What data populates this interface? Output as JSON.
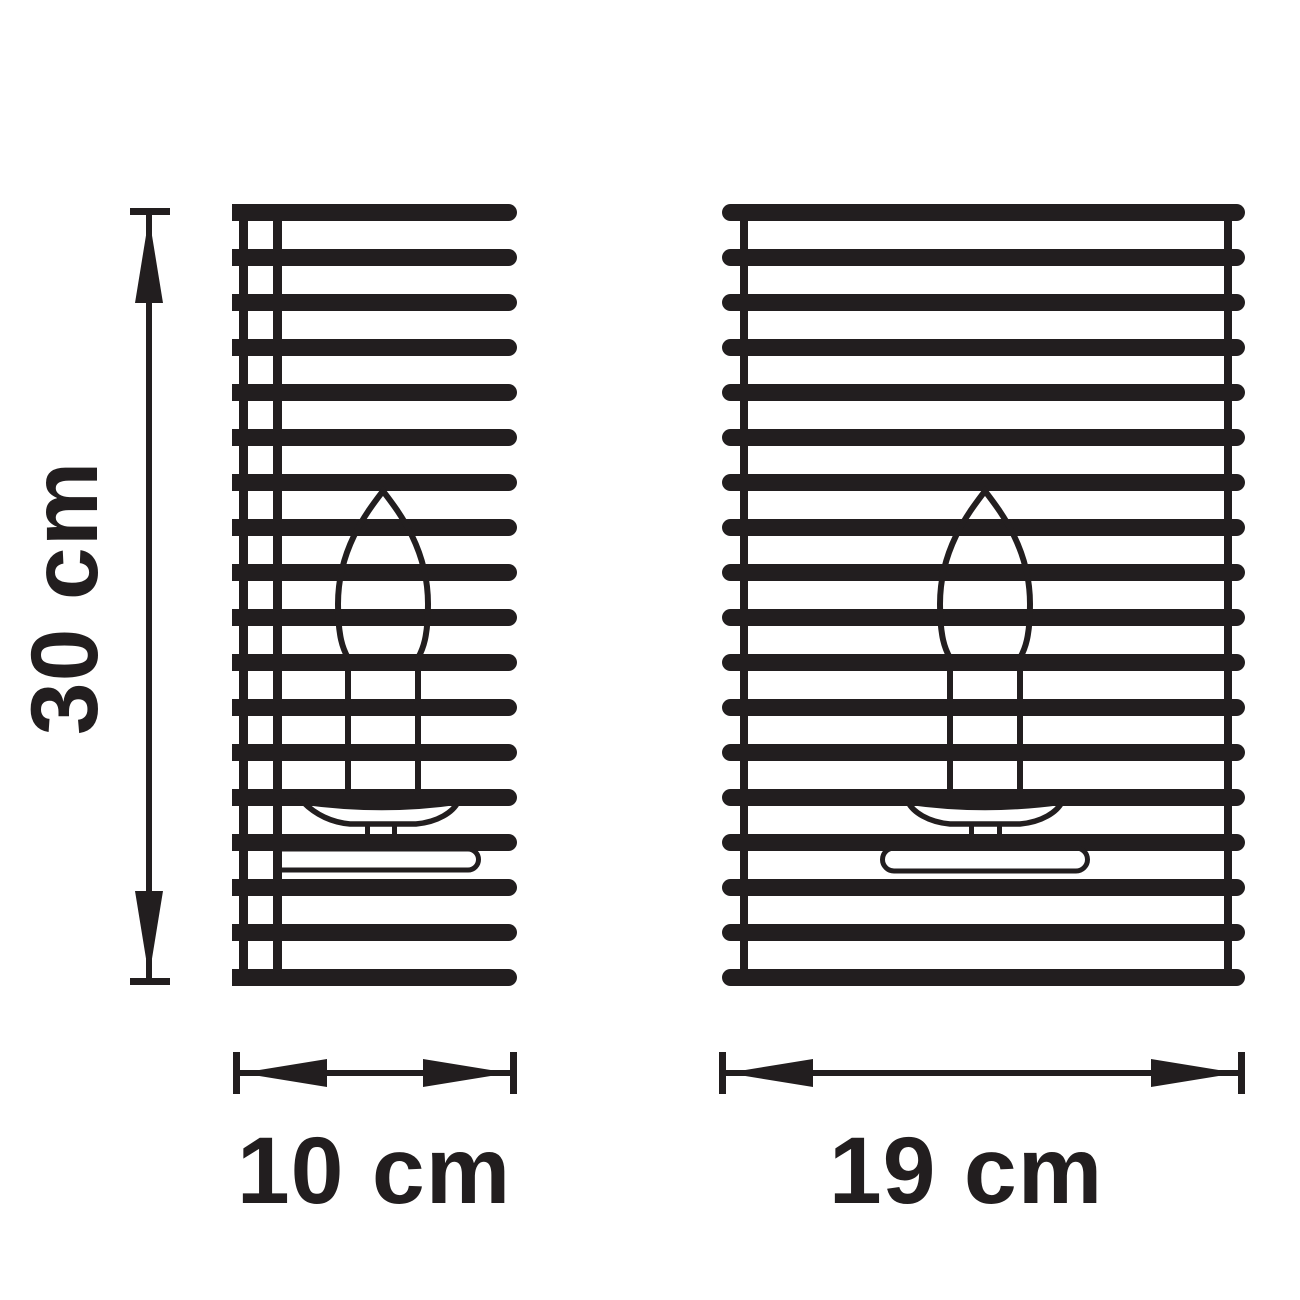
{
  "colors": {
    "ink": "#221e1f",
    "background": "#ffffff"
  },
  "diagram": {
    "kind": "product dimension drawing",
    "subject": "slatted wall sconce with candle bulb, shown in two orthographic views",
    "views": [
      {
        "name": "side view",
        "slats": 18,
        "width": "10 cm",
        "height": "30 cm"
      },
      {
        "name": "front view",
        "slats": 18,
        "width": "19 cm",
        "height": "30 cm"
      }
    ]
  },
  "labels": {
    "height": "30 cm",
    "width_left": "10 cm",
    "width_right": "19 cm"
  }
}
